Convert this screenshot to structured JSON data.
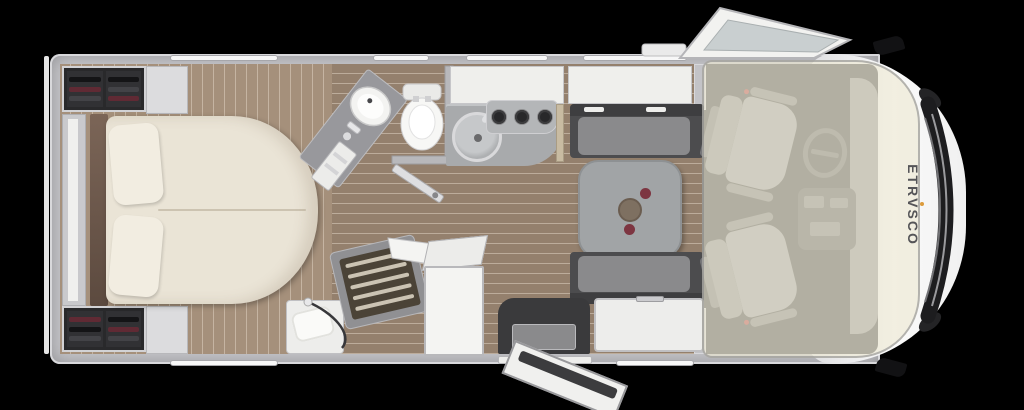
{
  "brand": {
    "logo_pre": "ETR",
    "logo_v": "V",
    "logo_post": "SCO",
    "logo_full": "ETRVSCO"
  },
  "plan": {
    "type": "motorhome-top-view-floorplan",
    "rooms": [
      "rear-bedroom",
      "bathroom",
      "shower",
      "kitchen",
      "dinette",
      "entrance",
      "driver-cab"
    ],
    "items": [
      "island-bed",
      "pillow",
      "pillow",
      "headboard",
      "rear-shelf",
      "wardrobe-with-clothes",
      "wardrobe-with-clothes",
      "bedside-cabinet",
      "bedside-cabinet",
      "corner-washbasin",
      "toilet",
      "bathroom-door",
      "shower-tray-with-grate",
      "shower-hose",
      "bench-with-towel",
      "tall-cabinet",
      "kitchen-sink",
      "hob-3-burner",
      "kitchen-worktop",
      "sideboard",
      "dinette-table",
      "bowl",
      "fruit",
      "bench-seat",
      "bench-seat",
      "storage-bench",
      "entry-step",
      "entrance-door-open",
      "driver-swivel-seat",
      "passenger-swivel-seat",
      "steering-wheel",
      "dashboard-console",
      "drop-down-bed-overlay",
      "cab-door-open",
      "wing-mirror",
      "wing-mirror",
      "front-grille",
      "headlight",
      "window-strip"
    ]
  },
  "colors": {
    "background": "#000000",
    "body_shell": "#f2f2f2",
    "wall": "#c3c3c7",
    "floor_wood": "#94806d",
    "bedroom_floor": "#a5907b",
    "bed_cream": "#eae4d6",
    "headboard_wood": "#6e5a4c",
    "clothes_maroon": "#602a34",
    "bench_dark": "#4c4c4e",
    "cushion_gray": "#8a8a8c",
    "table_gray": "#a1a4a6",
    "cab_overlay_beige": "#ece7d3",
    "fruit_red": "#7d3541",
    "logo_text": "#555558",
    "logo_accent": "#dc9b3c"
  }
}
